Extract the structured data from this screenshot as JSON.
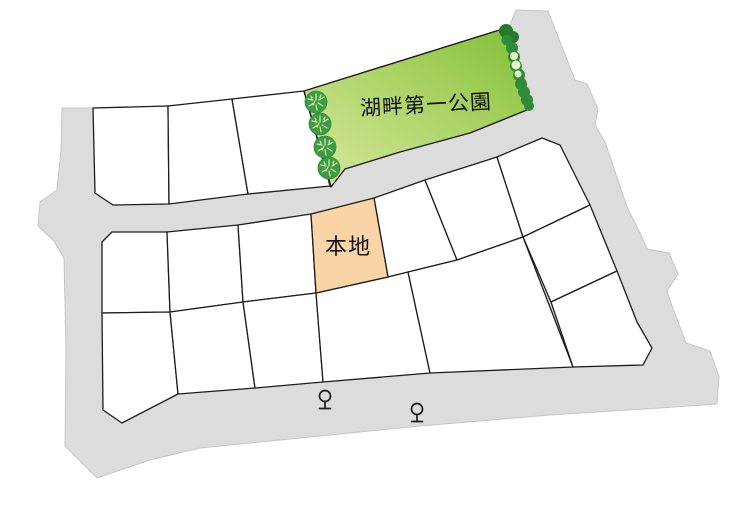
{
  "map": {
    "park": {
      "label": "湖畔第一公園",
      "tree_count": 4
    },
    "subject_lot": {
      "label": "本地"
    },
    "vacant_lot_count": 16,
    "streetlight_count": 2
  },
  "icons": {
    "park-tree-icon": "dark-green circle with light radial branch strokes",
    "park-hedge-icon": "scalloped dark-green strip with pale highlight along park edge",
    "streetlight-icon": "outlined circle on a short pole with a base bar"
  },
  "colors": {
    "road": "#dcdcdc",
    "road_edge": "#c6c6c6",
    "lot_fill": "#ffffff",
    "lot_stroke": "#1c1c1c",
    "park_green_light": "#d8e8a0",
    "park_green_mid": "#abd364",
    "park_green": "#7fbe37",
    "hedge_green": "#2e8b39",
    "hedge_dark": "#23792f",
    "hedge_light": "#e9f6c6",
    "tree_green": "#3d9b44",
    "tree_detail": "#d7ecae",
    "subject_fill": "#f8d4a6",
    "label_color": "#111111"
  }
}
